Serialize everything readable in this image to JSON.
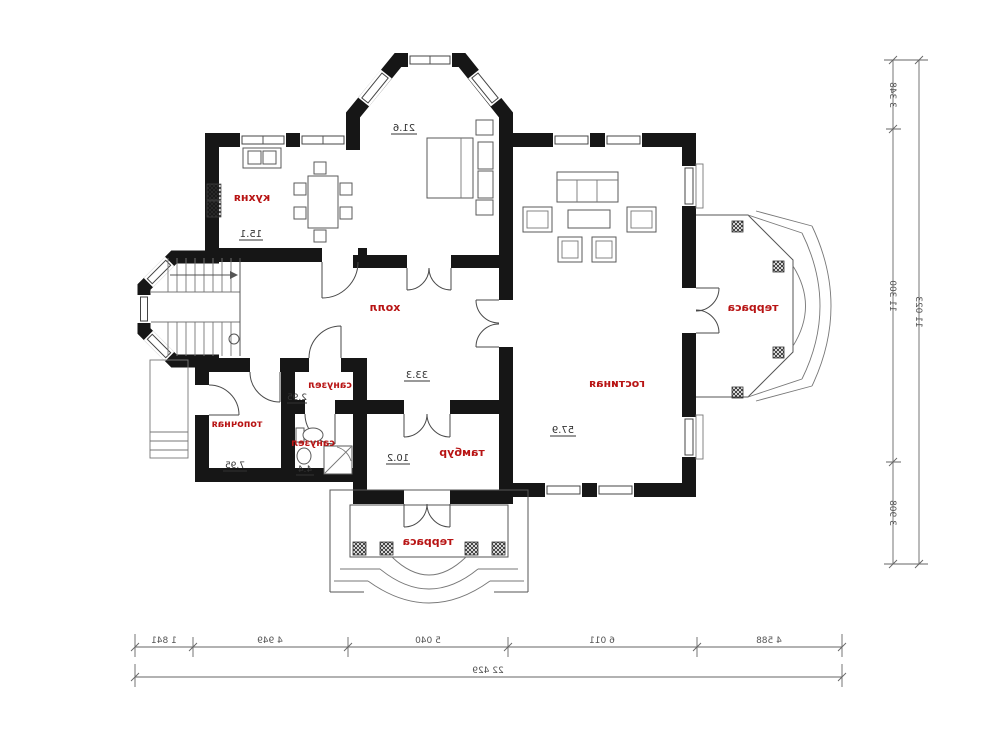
{
  "rooms": {
    "kitchen": {
      "label": "кухня",
      "area": "15.1"
    },
    "bedroom": {
      "area": "21.6"
    },
    "hall": {
      "label": "холл",
      "area": "33.3"
    },
    "living": {
      "label": "гостиная",
      "area": "57.9"
    },
    "terrace_right": {
      "label": "терраса"
    },
    "terrace_bottom": {
      "label": "терраса"
    },
    "tambour": {
      "label": "тамбур",
      "area": "10.2"
    },
    "wc_top": {
      "label": "санузел",
      "area": "2.95"
    },
    "wc_bottom": {
      "label": "санузел",
      "area": "4.4"
    },
    "boiler": {
      "label": "топочная",
      "area": "7.95"
    }
  },
  "dimensions": {
    "bottom_segments": [
      "1 841",
      "4 949",
      "5 040",
      "6 011",
      "4 588"
    ],
    "bottom_total": "22 429",
    "right_segments": [
      "3 348",
      "11 300",
      "3 908"
    ],
    "right_total": "11 023"
  },
  "colors": {
    "wall": "#161616",
    "room_label": "#b81414",
    "dimension": "#666666"
  }
}
